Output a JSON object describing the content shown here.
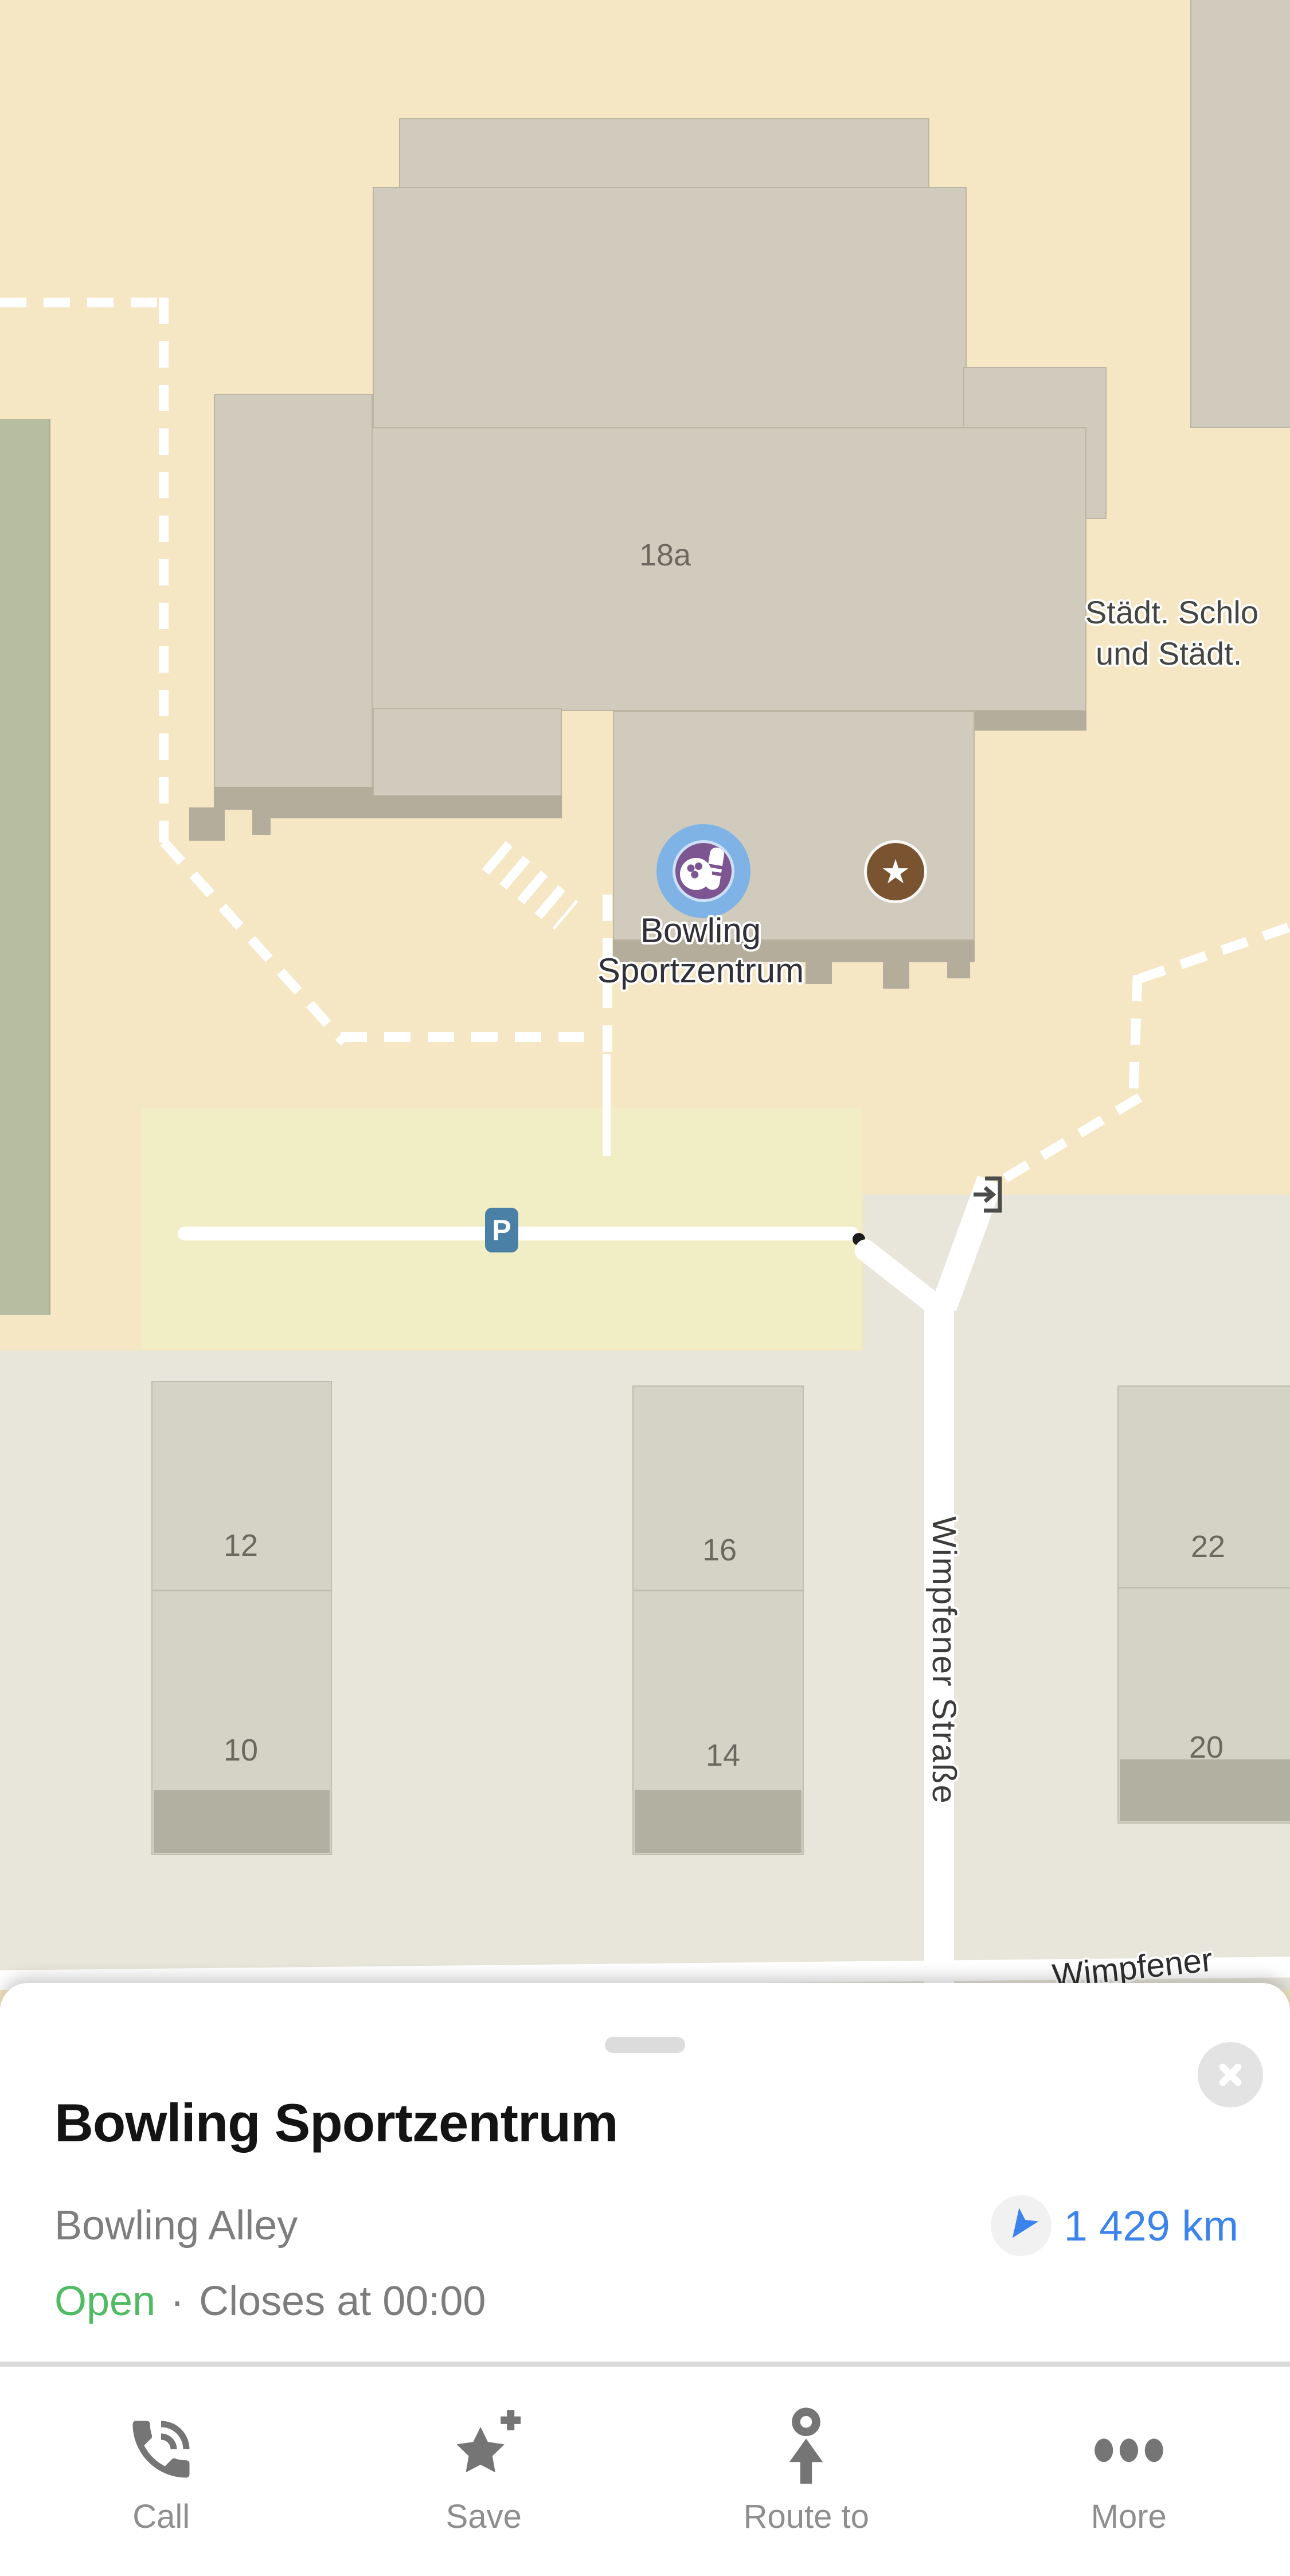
{
  "colors": {
    "map_beige": "#f5e7c3",
    "map_gray": "#e8e6db",
    "green_area": "#b7bd9f",
    "building": "#d1cbbd",
    "building_border": "#bcb5a4",
    "building_shadow": "#b4ad9c",
    "lower_building": "#d5d3c5",
    "lower_building_border": "#bfbdae",
    "lower_building_shadow": "#b2b1a1",
    "parking": "#f1eec6",
    "parking_badge": "#4b80a6",
    "road_white": "#ffffff",
    "map_label": "#3c3c3b",
    "house_number": "#6b685f",
    "poi_halo_blue": "#7fb3e6",
    "poi_purple": "#7d5590",
    "star_brown": "#7a5330",
    "accent_blue": "#3c83ec",
    "open_green": "#50bb62",
    "text_primary": "#141414",
    "text_secondary": "#7d7d7d",
    "icon_gray": "#757575",
    "divider": "#dbdbdb",
    "handle": "#dcdcdc",
    "close_bg": "#e3e3e3"
  },
  "map": {
    "house_numbers": {
      "main": "18a",
      "b12": "12",
      "b10": "10",
      "b16": "16",
      "b14": "14",
      "b22": "22",
      "b20": "20"
    },
    "streets": {
      "vertical": "Wimpfener Straße",
      "bottom": "Wimpfener"
    },
    "area_label": {
      "line1": "Städt. Schlo",
      "line2": "und Städt."
    },
    "poi": {
      "label_line1": "Bowling",
      "label_line2": "Sportzentrum",
      "marker_icon": "bowling-icon",
      "saved_icon": "star-icon"
    },
    "parking": {
      "badge": "P"
    },
    "entrance_icon": "entrance-arrow-icon"
  },
  "sheet": {
    "title": "Bowling Sportzentrum",
    "category": "Bowling Alley",
    "distance": "1 429 km",
    "distance_icon": "navigation-arrow-icon",
    "status": {
      "open": "Open",
      "separator": "·",
      "hours": "Closes at 00:00"
    },
    "close_icon": "close-icon",
    "handle_icon": "drag-handle",
    "actions": [
      {
        "label": "Call",
        "icon": "phone-icon"
      },
      {
        "label": "Save",
        "icon": "star-plus-icon"
      },
      {
        "label": "Route to",
        "icon": "route-marker-icon"
      },
      {
        "label": "More",
        "icon": "ellipsis-icon"
      }
    ]
  }
}
